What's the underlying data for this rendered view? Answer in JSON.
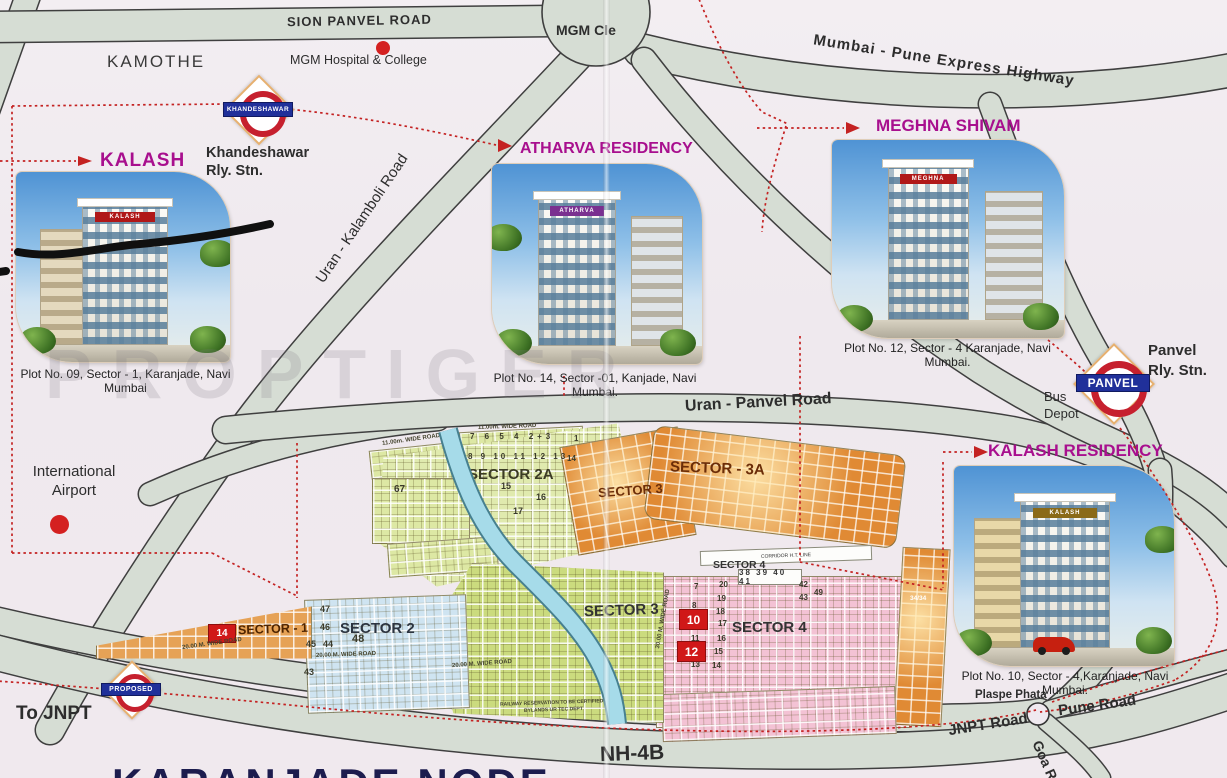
{
  "title": "KARANJADE NODE",
  "watermark": "PROPTIGER",
  "colors": {
    "accent_magenta": "#a80f8e",
    "highlight_red": "#d01818",
    "road_fill": "#d6ddd4",
    "canal_blue": "#a6dbe9",
    "sector_orange": "#e08a34",
    "sector_green": "#dde8a4",
    "sector_pink": "#f3c2d4",
    "sector_blue": "#cfe4f1"
  },
  "roads": {
    "sion_panvel": "SION PANVEL ROAD",
    "mgm_circle": "MGM Cle",
    "mumbai_pune_expressway": "Mumbai - Pune Express Highway",
    "uran_kalamboli": "Uran - Kalamboli Road",
    "uran_panvel": "Uran - Panvel Road",
    "nh_4b": "NH-4B",
    "jnpt_road": "JNPT Road",
    "pune_road": "Pune Road",
    "goa_road": "Goa R",
    "to_jnpt": "To JNPT"
  },
  "places": {
    "kamothe": "KAMOTHE",
    "mgm_hospital": "MGM Hospital & College",
    "airport_line1": "International",
    "airport_line2": "Airport",
    "bus_line1": "Bus",
    "bus_line2": "Depot",
    "plaspe_phata": "Plaspe Phata"
  },
  "stations": {
    "khandeshawar": {
      "banner": "KHANDESHAWAR",
      "caption_line1": "Khandeshawar",
      "caption_line2": "Rly. Stn."
    },
    "panvel": {
      "banner": "PANVEL",
      "caption_line1": "Panvel",
      "caption_line2": "Rly. Stn."
    },
    "proposed": {
      "banner": "PROPOSED"
    }
  },
  "projects": [
    {
      "name": "KALASH",
      "sign": "KALASH",
      "caption": "Plot No. 09, Sector - 1, Karanjade, Navi Mumbai"
    },
    {
      "name": "ATHARVA RESIDENCY",
      "sign": "ATHARVA",
      "caption": "Plot No. 14, Sector -01, Kanjade, Navi Mumbai."
    },
    {
      "name": "MEGHNA SHIVAM",
      "sign": "MEGHNA",
      "caption": "Plot No. 12, Sector - 4 Karanjade, Navi Mumbai."
    },
    {
      "name": "KALASH RESIDENCY",
      "sign": "KALASH",
      "caption": "Plot No. 10, Sector - 4,Karanjade, Navi Mumbai."
    }
  ],
  "sector_map": {
    "s2a": {
      "label": "SECTOR 2A",
      "row1": "7 6 5 4 2+3",
      "row2": "8 9 10 11 12 13",
      "cell1": "1",
      "cell2": "14",
      "p15": "15",
      "p16": "16",
      "p17": "17",
      "p67": "67"
    },
    "s3_upper": {
      "label": "SECTOR 3"
    },
    "s3a": {
      "label": "SECTOR - 3A"
    },
    "s4": {
      "label_small": "SECTOR 4",
      "corridor": "CORRIDOR H.T. LINE",
      "strip": "38 39 40 41",
      "label": "SECTOR 4",
      "colA": [
        "7",
        "8",
        "11",
        "13"
      ],
      "colB": [
        "20",
        "19",
        "18",
        "17",
        "16",
        "15",
        "14"
      ],
      "colC": [
        "42",
        "49",
        "43"
      ],
      "red_plots": [
        "10",
        "12"
      ]
    },
    "s3_lower": {
      "label": "SECTOR 3",
      "note_line1": "RAILWAY RESERVATION TO BE CERTIFIED",
      "note_line2": "BYLANDS UR TEC DEPT"
    },
    "s2": {
      "label": "SECTOR 2",
      "plots": [
        "47",
        "46",
        "45",
        "44",
        "48",
        "43"
      ]
    },
    "s1": {
      "label": "SECTOR - 1",
      "red_plot": "14"
    },
    "road_labels": {
      "w11": "11.00m. WIDE ROAD",
      "w20": "20.00 M. WIDE ROAD",
      "w30": "30.00 M. WIDE ROAD"
    },
    "orange_strip_plot": "34/34"
  }
}
